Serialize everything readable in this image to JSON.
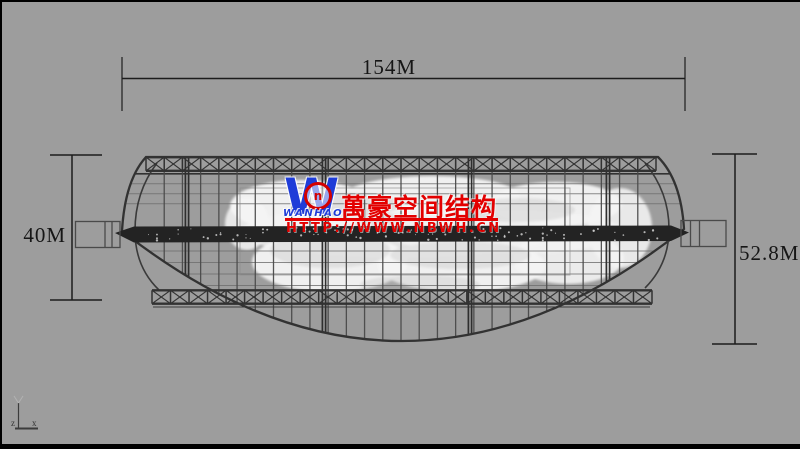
{
  "viewport": {
    "description_label": ""
  },
  "colors": {
    "background": "#9d9d9d",
    "line_dark": "#323232",
    "line_mid": "#4a4a4a",
    "line_light": "#6e6e6e",
    "spine": "#232323",
    "dim_ink": "#1c1c1c",
    "blob_white": "#f4f4f4",
    "brand_blue": "#1e3cd8",
    "brand_red": "#e30000",
    "ring_red": "#d40000"
  },
  "dimensions": {
    "top": {
      "label": "154M"
    },
    "left": {
      "label": "40M"
    },
    "right": {
      "label": "52.8M"
    }
  },
  "axis": {
    "z": "z",
    "x": "x"
  },
  "watermark": {
    "logo_letter": "W",
    "ring_glyph": "n",
    "logo_sub": "WANHAO",
    "title": "萬豪空间结构",
    "url": "HTTP://WWW.NBWH.CN"
  }
}
